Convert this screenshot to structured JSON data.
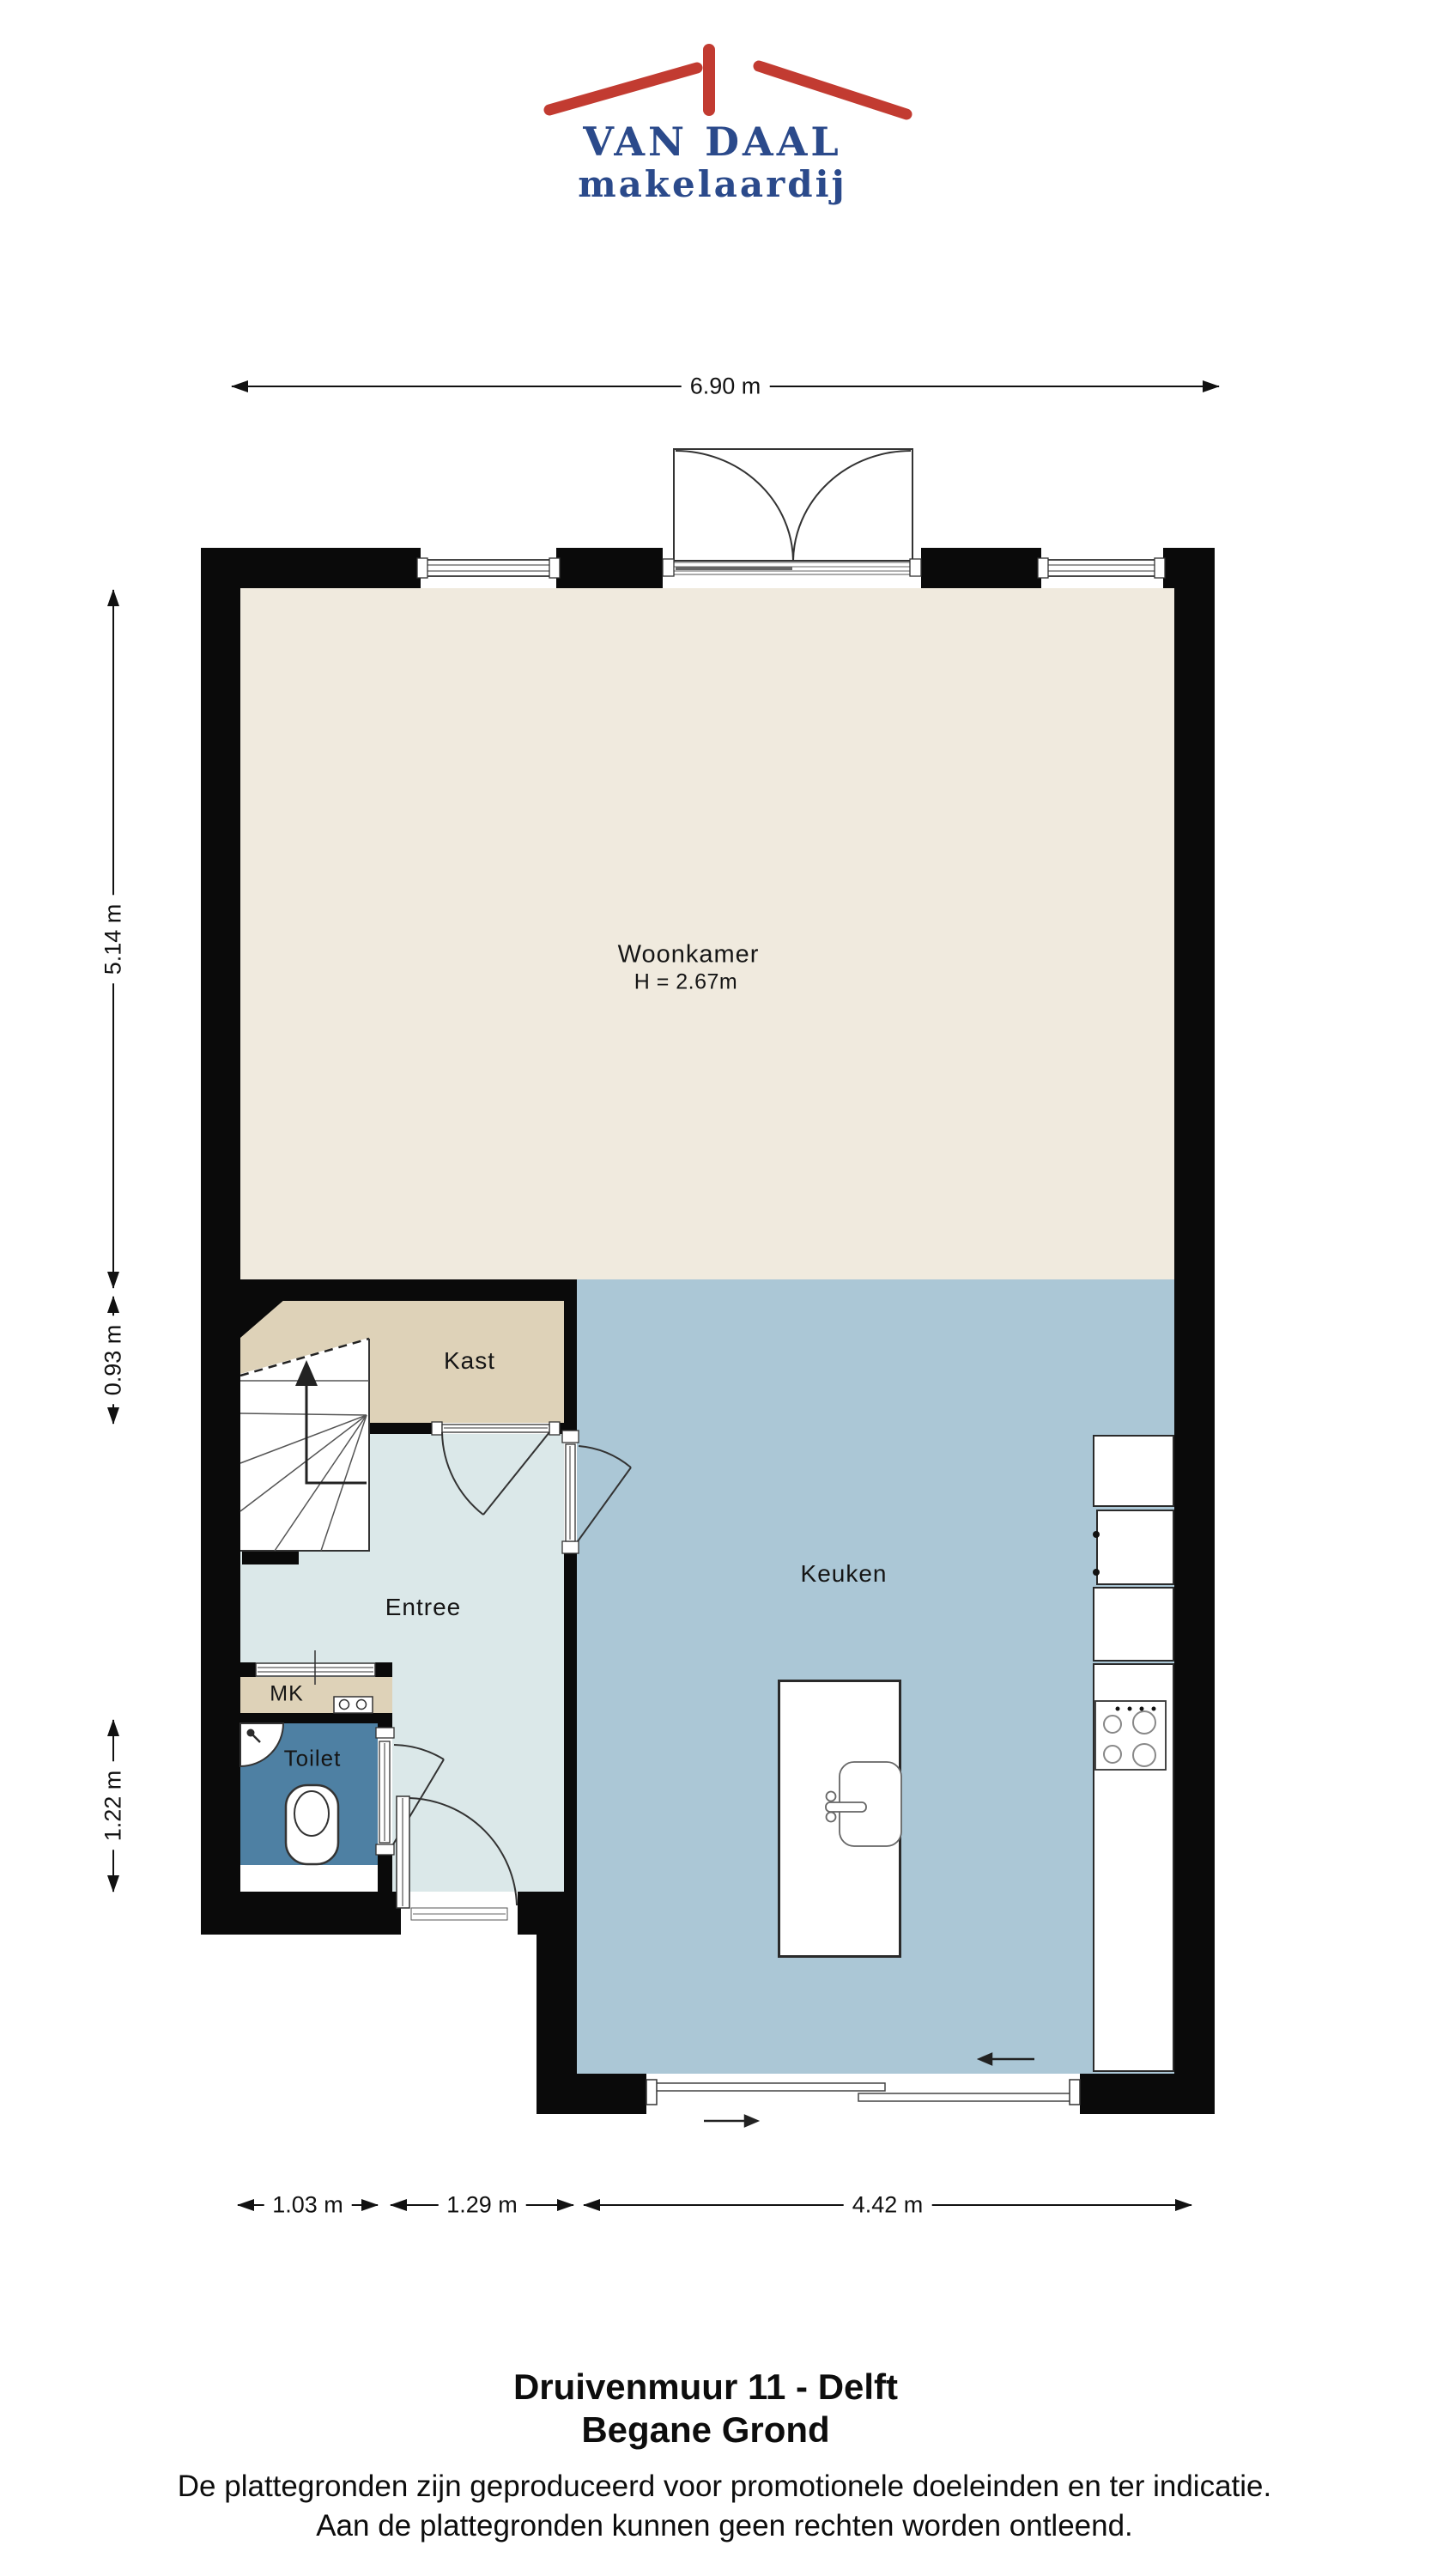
{
  "logo": {
    "line1": "VAN DAAL",
    "line2": "makelaardij"
  },
  "rooms": {
    "woonkamer": {
      "label": "Woonkamer",
      "ceiling_height": "H = 2.67m"
    },
    "kast": {
      "label": "Kast"
    },
    "entree": {
      "label": "Entree"
    },
    "mk": {
      "label": "MK"
    },
    "toilet": {
      "label": "Toilet"
    },
    "keuken": {
      "label": "Keuken"
    }
  },
  "dimensions": {
    "top_width": "6.90 m",
    "left_woonkamer": "5.14 m",
    "left_kast": "0.93 m",
    "left_toilet": "1.22 m",
    "bottom_toilet": "1.03 m",
    "bottom_entree": "1.29 m",
    "bottom_keuken": "4.42 m"
  },
  "footer": {
    "title_line1": "Druivenmuur 11 - Delft",
    "title_line2": "Begane Grond",
    "disclaimer_line1": "De plattegronden zijn geproduceerd voor promotionele doeleinden en ter indicatie.",
    "disclaimer_line2": "Aan de plattegronden kunnen geen rechten worden ontleend."
  },
  "colors": {
    "wall": "#0a0a0a",
    "woonkamer": "#f0eade",
    "kast": "#ded2b8",
    "entree": "#dbe8e9",
    "keuken": "#abc7d6",
    "toilet": "#4e80a3",
    "logo_red": "#c23b31",
    "logo_blue": "#2b4a8b"
  }
}
